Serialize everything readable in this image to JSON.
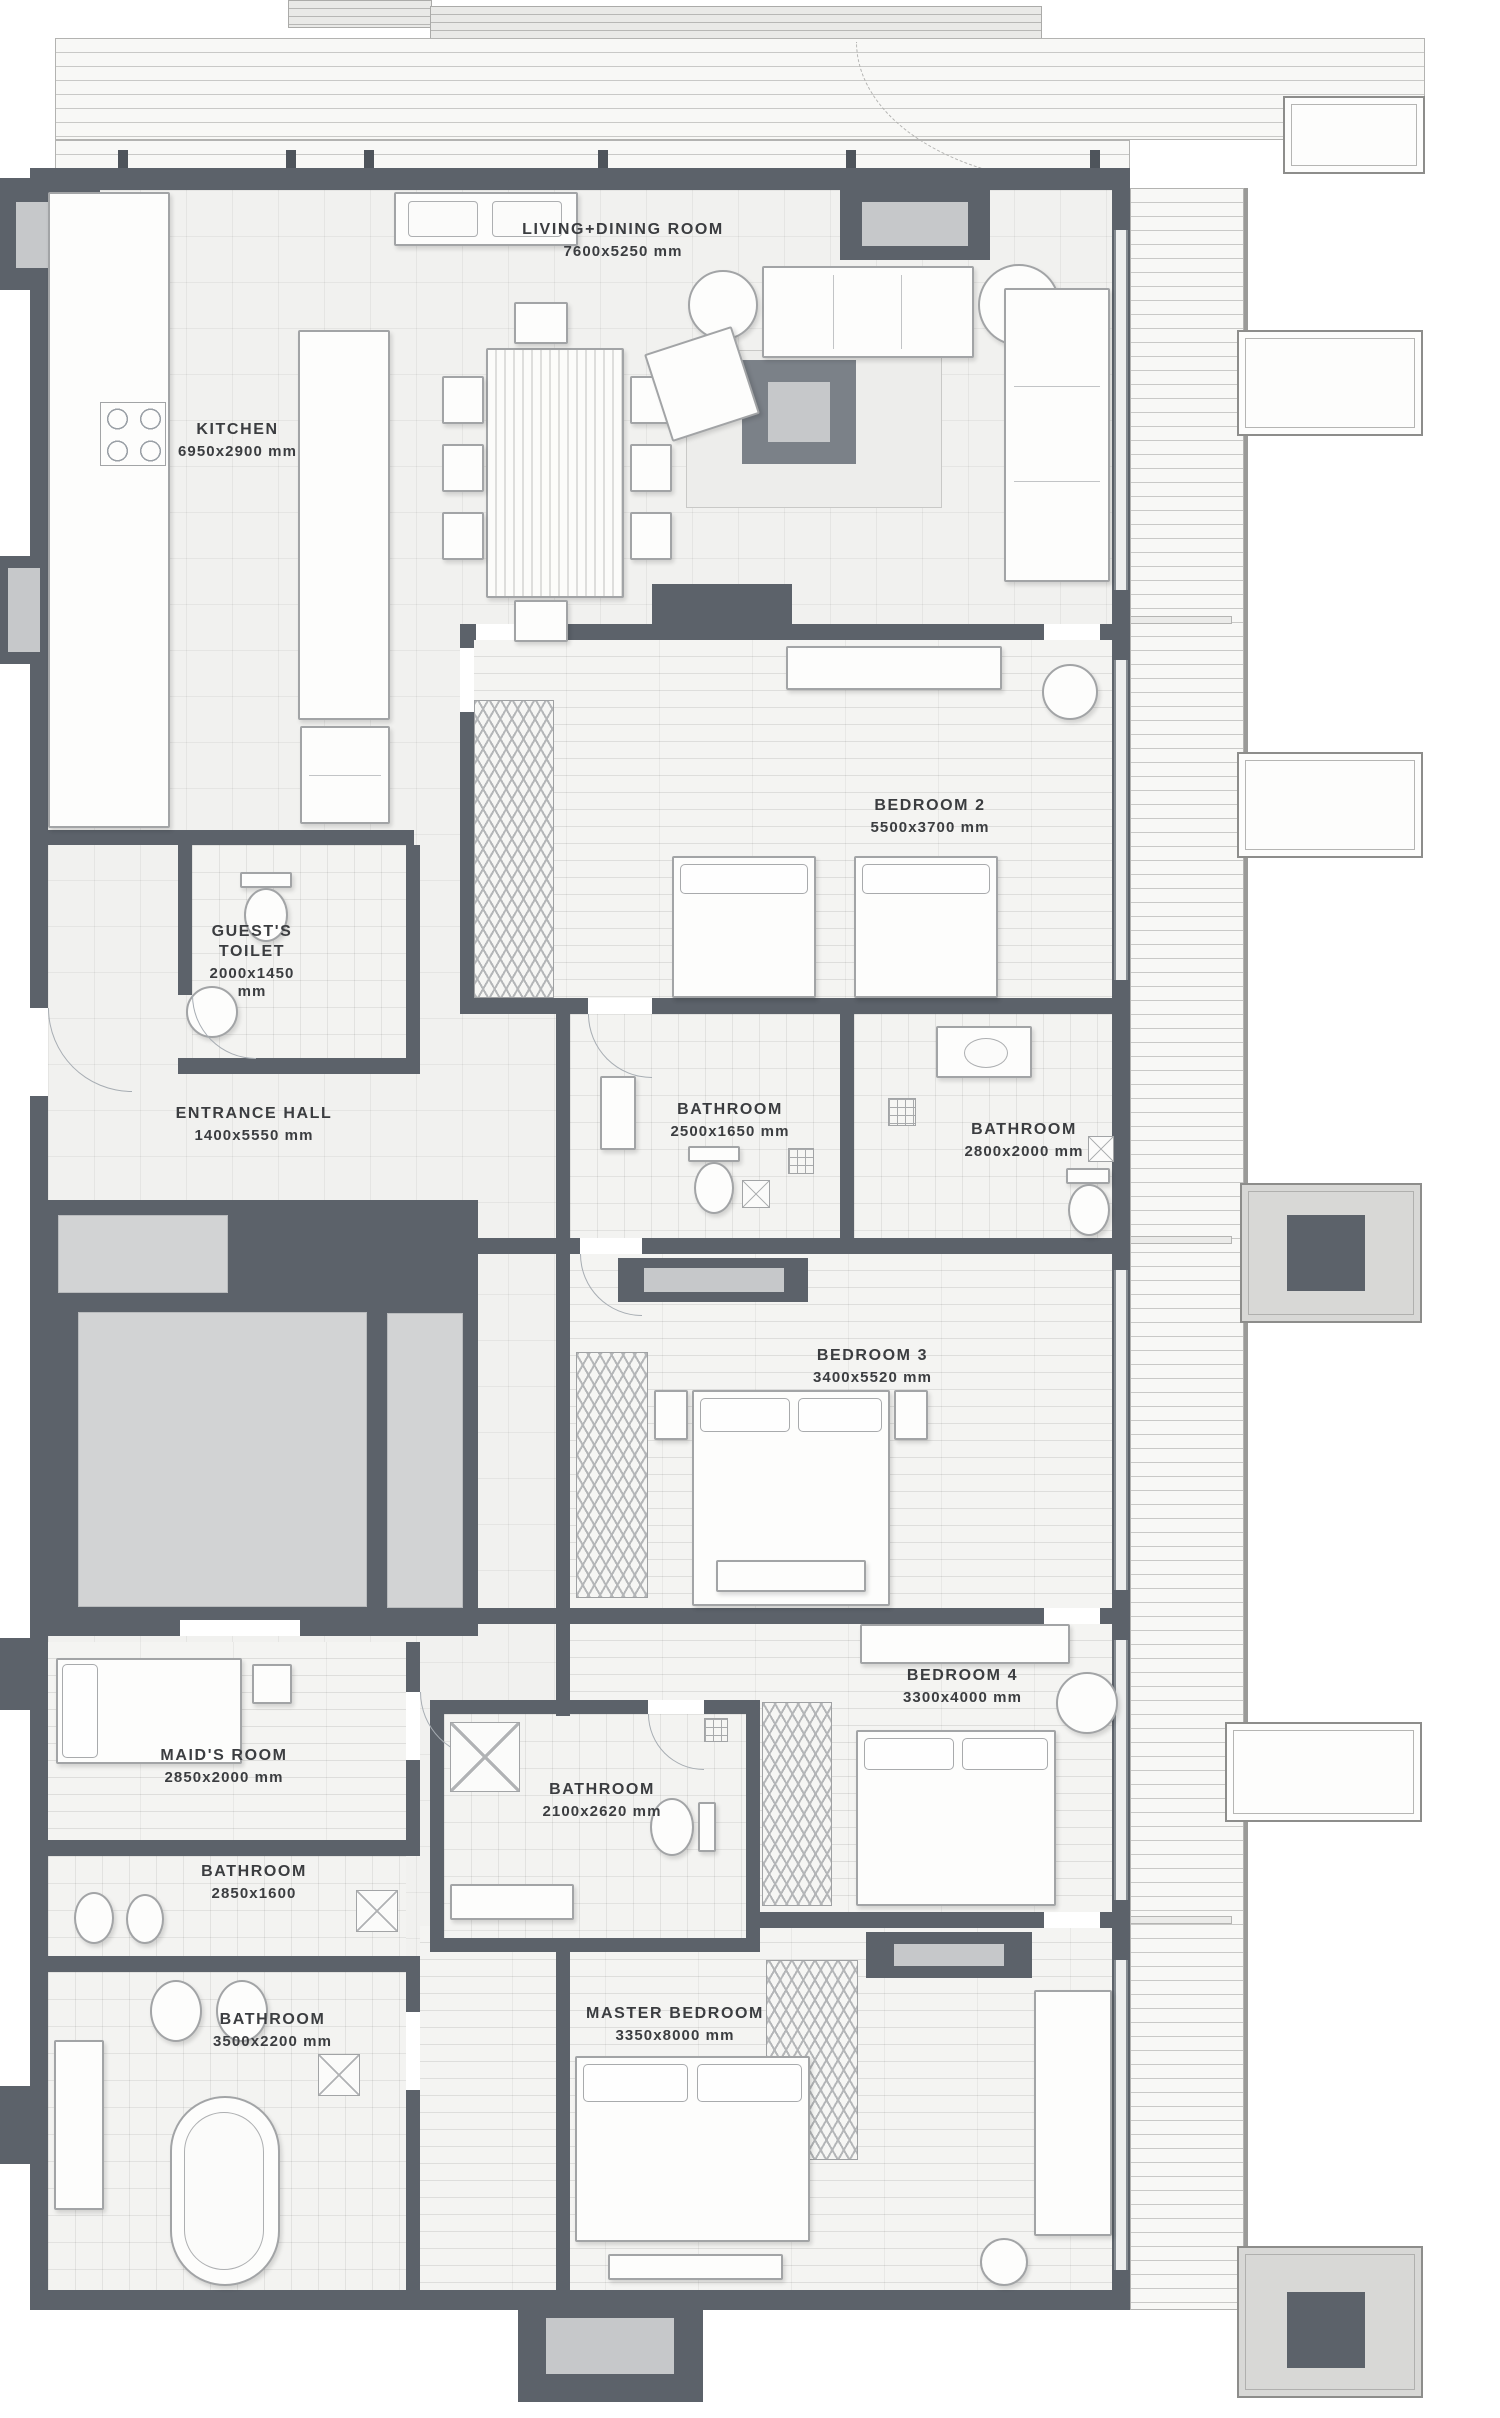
{
  "rooms": {
    "living": {
      "name": "LIVING+DINING ROOM",
      "dims": "7600x5250 mm"
    },
    "kitchen": {
      "name": "KITCHEN",
      "dims": "6950x2900 mm"
    },
    "bedroom2": {
      "name": "BEDROOM 2",
      "dims": "5500x3700 mm"
    },
    "guest_toilet": {
      "name": "GUEST'S TOILET",
      "dims": "2000x1450 mm"
    },
    "entrance_hall": {
      "name": "ENTRANCE HALL",
      "dims": "1400x5550 mm"
    },
    "bathroom_2500": {
      "name": "BATHROOM",
      "dims": "2500x1650 mm"
    },
    "bathroom_2800": {
      "name": "BATHROOM",
      "dims": "2800x2000 mm"
    },
    "bedroom3": {
      "name": "BEDROOM 3",
      "dims": "3400x5520 mm"
    },
    "bedroom4": {
      "name": "BEDROOM 4",
      "dims": "3300x4000 mm"
    },
    "maids_room": {
      "name": "MAID'S ROOM",
      "dims": "2850x2000 mm"
    },
    "bathroom_2850": {
      "name": "BATHROOM",
      "dims": "2850x1600"
    },
    "bathroom_2100": {
      "name": "BATHROOM",
      "dims": "2100x2620 mm"
    },
    "bathroom_3500": {
      "name": "BATHROOM",
      "dims": "3500x2200 mm"
    },
    "master": {
      "name": "MASTER BEDROOM",
      "dims": "3350x8000 mm"
    }
  },
  "colors": {
    "wall": "#5c626a",
    "floor": "#f1f1ef",
    "core_fill": "#d2d3d4",
    "column_fill": "#c6c8ca",
    "deck_line": "#c9c9c7",
    "text": "#3b3d40"
  }
}
